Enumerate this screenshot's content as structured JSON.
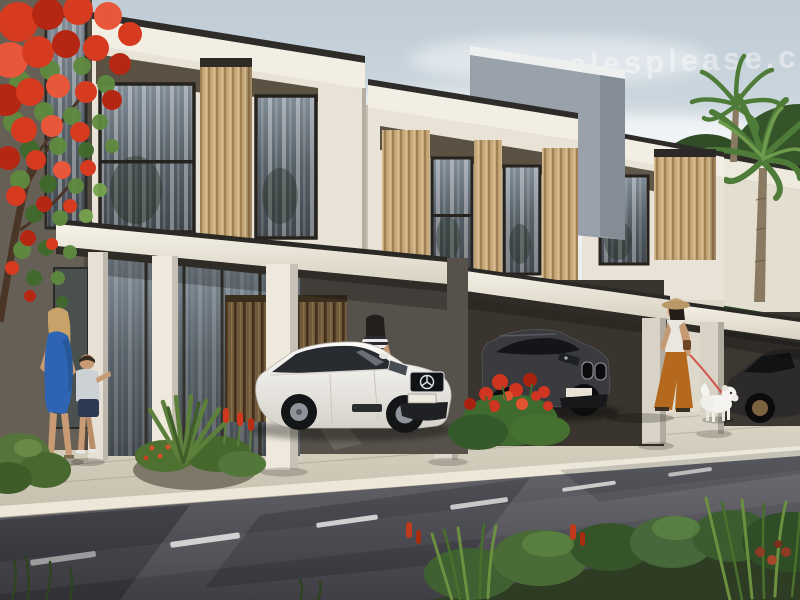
{
  "watermark": {
    "text": "salesplease.co"
  },
  "scene": {
    "type": "photorealistic architectural render",
    "subject": "Modern two-storey townhouse row with carports, parked cars, pedestrians, flame tree, palms and a landscaped street",
    "objects": [
      "flame-tree",
      "townhouse-1",
      "townhouse-2",
      "townhouse-3",
      "townhouse-4",
      "carport-canopies",
      "white-mercedes-sedan",
      "dark-bmw-suv",
      "dark-sedan-partial",
      "woman-in-blue-dress",
      "little-boy",
      "woman-checking-phone",
      "woman-walking-dog",
      "white-dog",
      "palm-trees",
      "sidewalk",
      "road-with-lane-markings",
      "landscaping"
    ]
  },
  "palette": {
    "sky_top": "#bfccd6",
    "wall_cream": "#e8e3d6",
    "parapet_white": "#f2eee3",
    "panel_dark": "#5a5142",
    "wood_slat": "#c6a87a",
    "glass": "#4c565e",
    "carport_shadow": "#39352e",
    "paver": "#d5cfc0",
    "curb": "#ece7d8",
    "road": "#4a4a50",
    "lane_mark": "#e8e8e6",
    "foliage_green": "#4a6b36",
    "flame_red": "#d63a1f",
    "palm_green": "#4e7c38",
    "mercedes_white": "#f4f2ee",
    "bmw_gray": "#3b3b3f",
    "dark_sedan_gray": "#2c2a2a",
    "dress_blue": "#2f64b5",
    "pants_rust": "#b5691f",
    "leash_red": "#d4504a",
    "dog_white": "#f4f3ef",
    "skin": "#c99b74",
    "hat_tan": "#c9a87a"
  }
}
